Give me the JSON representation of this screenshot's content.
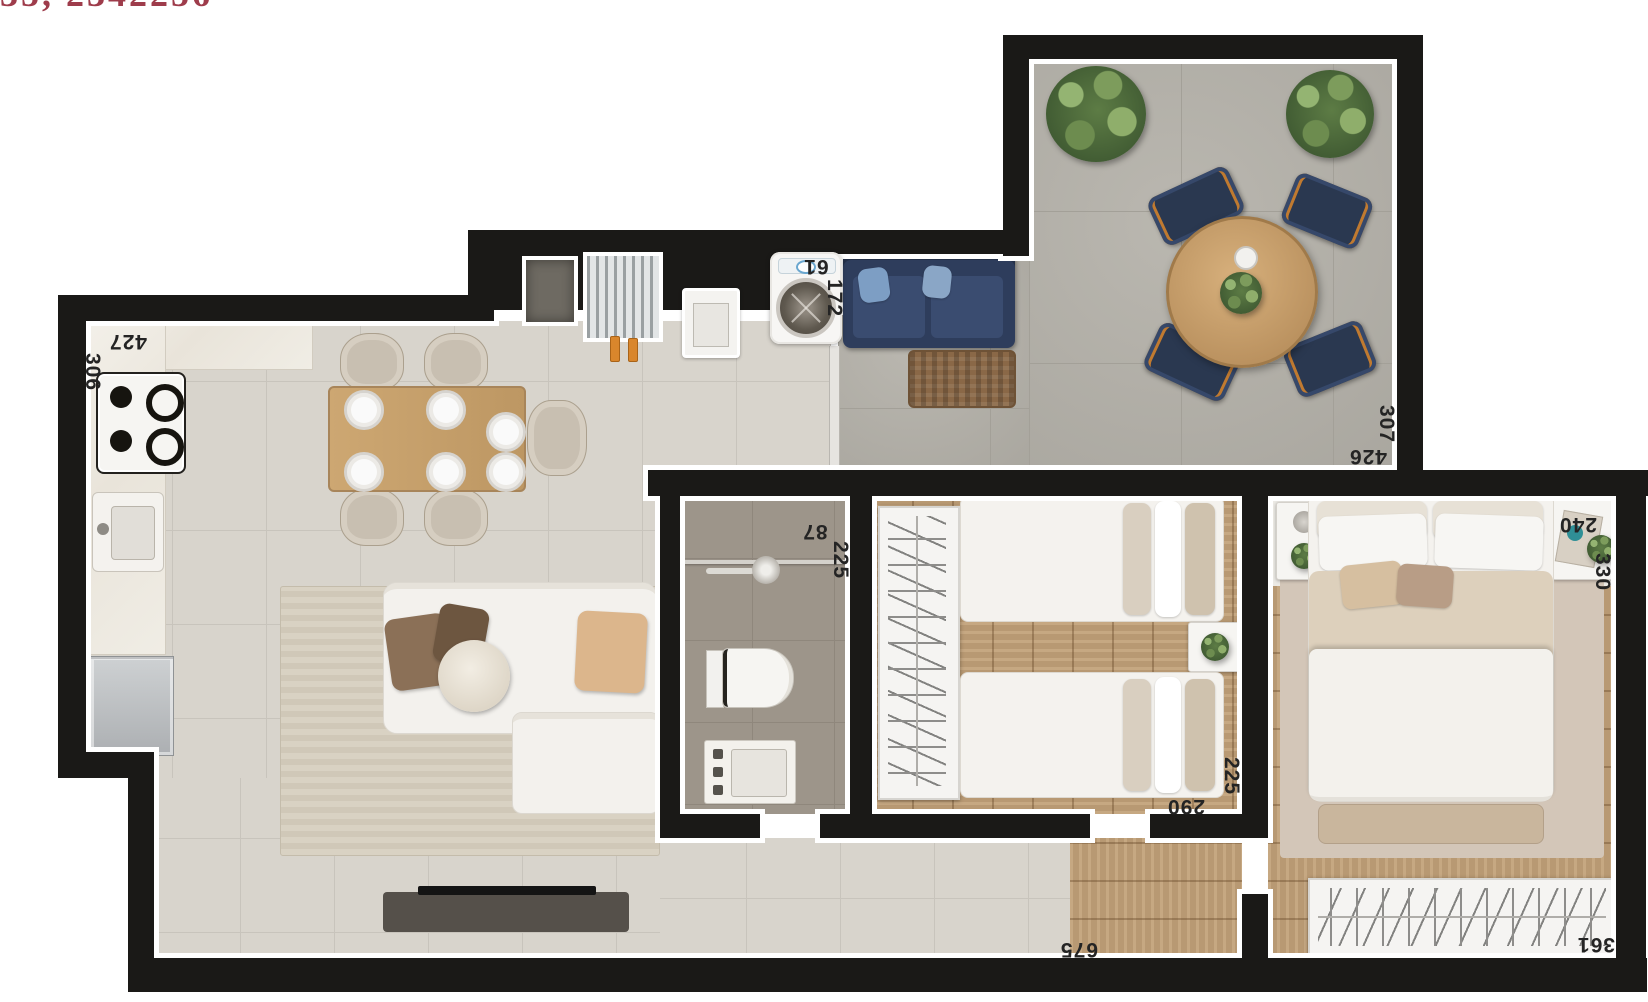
{
  "watermark": {
    "text": "35, 2342256"
  },
  "dimensions": {
    "kitchen": {
      "horizontal": "427",
      "vertical": "306"
    },
    "laundry": {
      "horizontal": "61",
      "vertical": "172"
    },
    "bathroom": {
      "horizontal": "87",
      "vertical": "225"
    },
    "terrace": {
      "horizontal": "426",
      "vertical": "307"
    },
    "bedroom2": {
      "horizontal": "290",
      "vertical": "225"
    },
    "master_bedroom": {
      "horizontal": "240",
      "vertical": "330"
    },
    "living_room": {
      "horizontal": "675"
    },
    "wardrobe": {
      "horizontal": "361"
    }
  },
  "palette": {
    "wall": "#1a1917",
    "tile_floor": "#d8d4cc",
    "terrace_floor": "#b4b1a9",
    "bathroom_floor": "#9d958a",
    "wood_floor": "#c2a179",
    "outdoor_navy": "#2a3850",
    "wood_table": "#c9a271",
    "plant_green": "#5d7c45",
    "label_text": "#242424",
    "watermark_red": "#9e3c4b"
  }
}
